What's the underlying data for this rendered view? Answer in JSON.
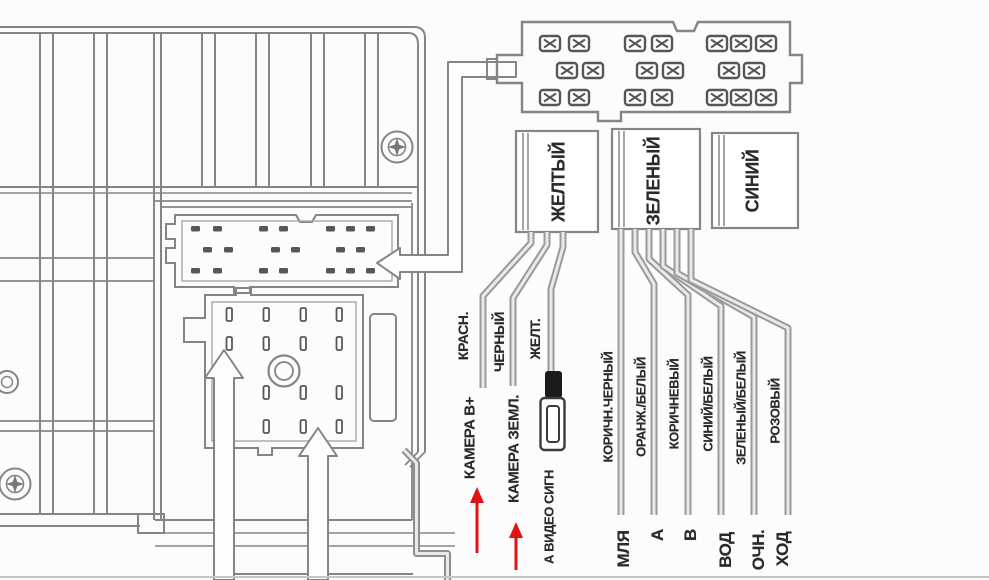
{
  "connector_blocks": {
    "yellow_label": "ЖЕЛТЫЙ",
    "green_label": "ЗЕЛЕНЫЙ",
    "blue_label": "СИНИЙ"
  },
  "camera_wires": [
    {
      "color": "КРАСН.",
      "function": "КАМЕРА В+"
    },
    {
      "color": "ЧЕРНЫЙ",
      "function": "КАМЕРА ЗЕМЛ."
    },
    {
      "color": "ЖЕЛТ.",
      "function": "А ВИДЕО СИГН"
    }
  ],
  "harness_wires": [
    {
      "color": "КОРИЧН.ЧЕРНЫЙ",
      "function": "МЛЯ"
    },
    {
      "color": "ОРАНЖ./БЕЛЫЙ",
      "function": "А"
    },
    {
      "color": "КОРИЧНЕВЫЙ",
      "function": "В"
    },
    {
      "color": "СИНИЙ/БЕЛЫЙ",
      "function": "ВОД"
    },
    {
      "color": "ЗЕЛЕНЫЙ/БЕЛЫЙ",
      "function": "ОЧН."
    },
    {
      "color": "РОЗОВЫЙ",
      "function": "ХОД"
    }
  ],
  "colors": {
    "line": "#858585",
    "dark": "#4d4d4d",
    "text": "#2a2a2a",
    "red_arrow": "#e01212",
    "background": "#fcfcfc"
  }
}
